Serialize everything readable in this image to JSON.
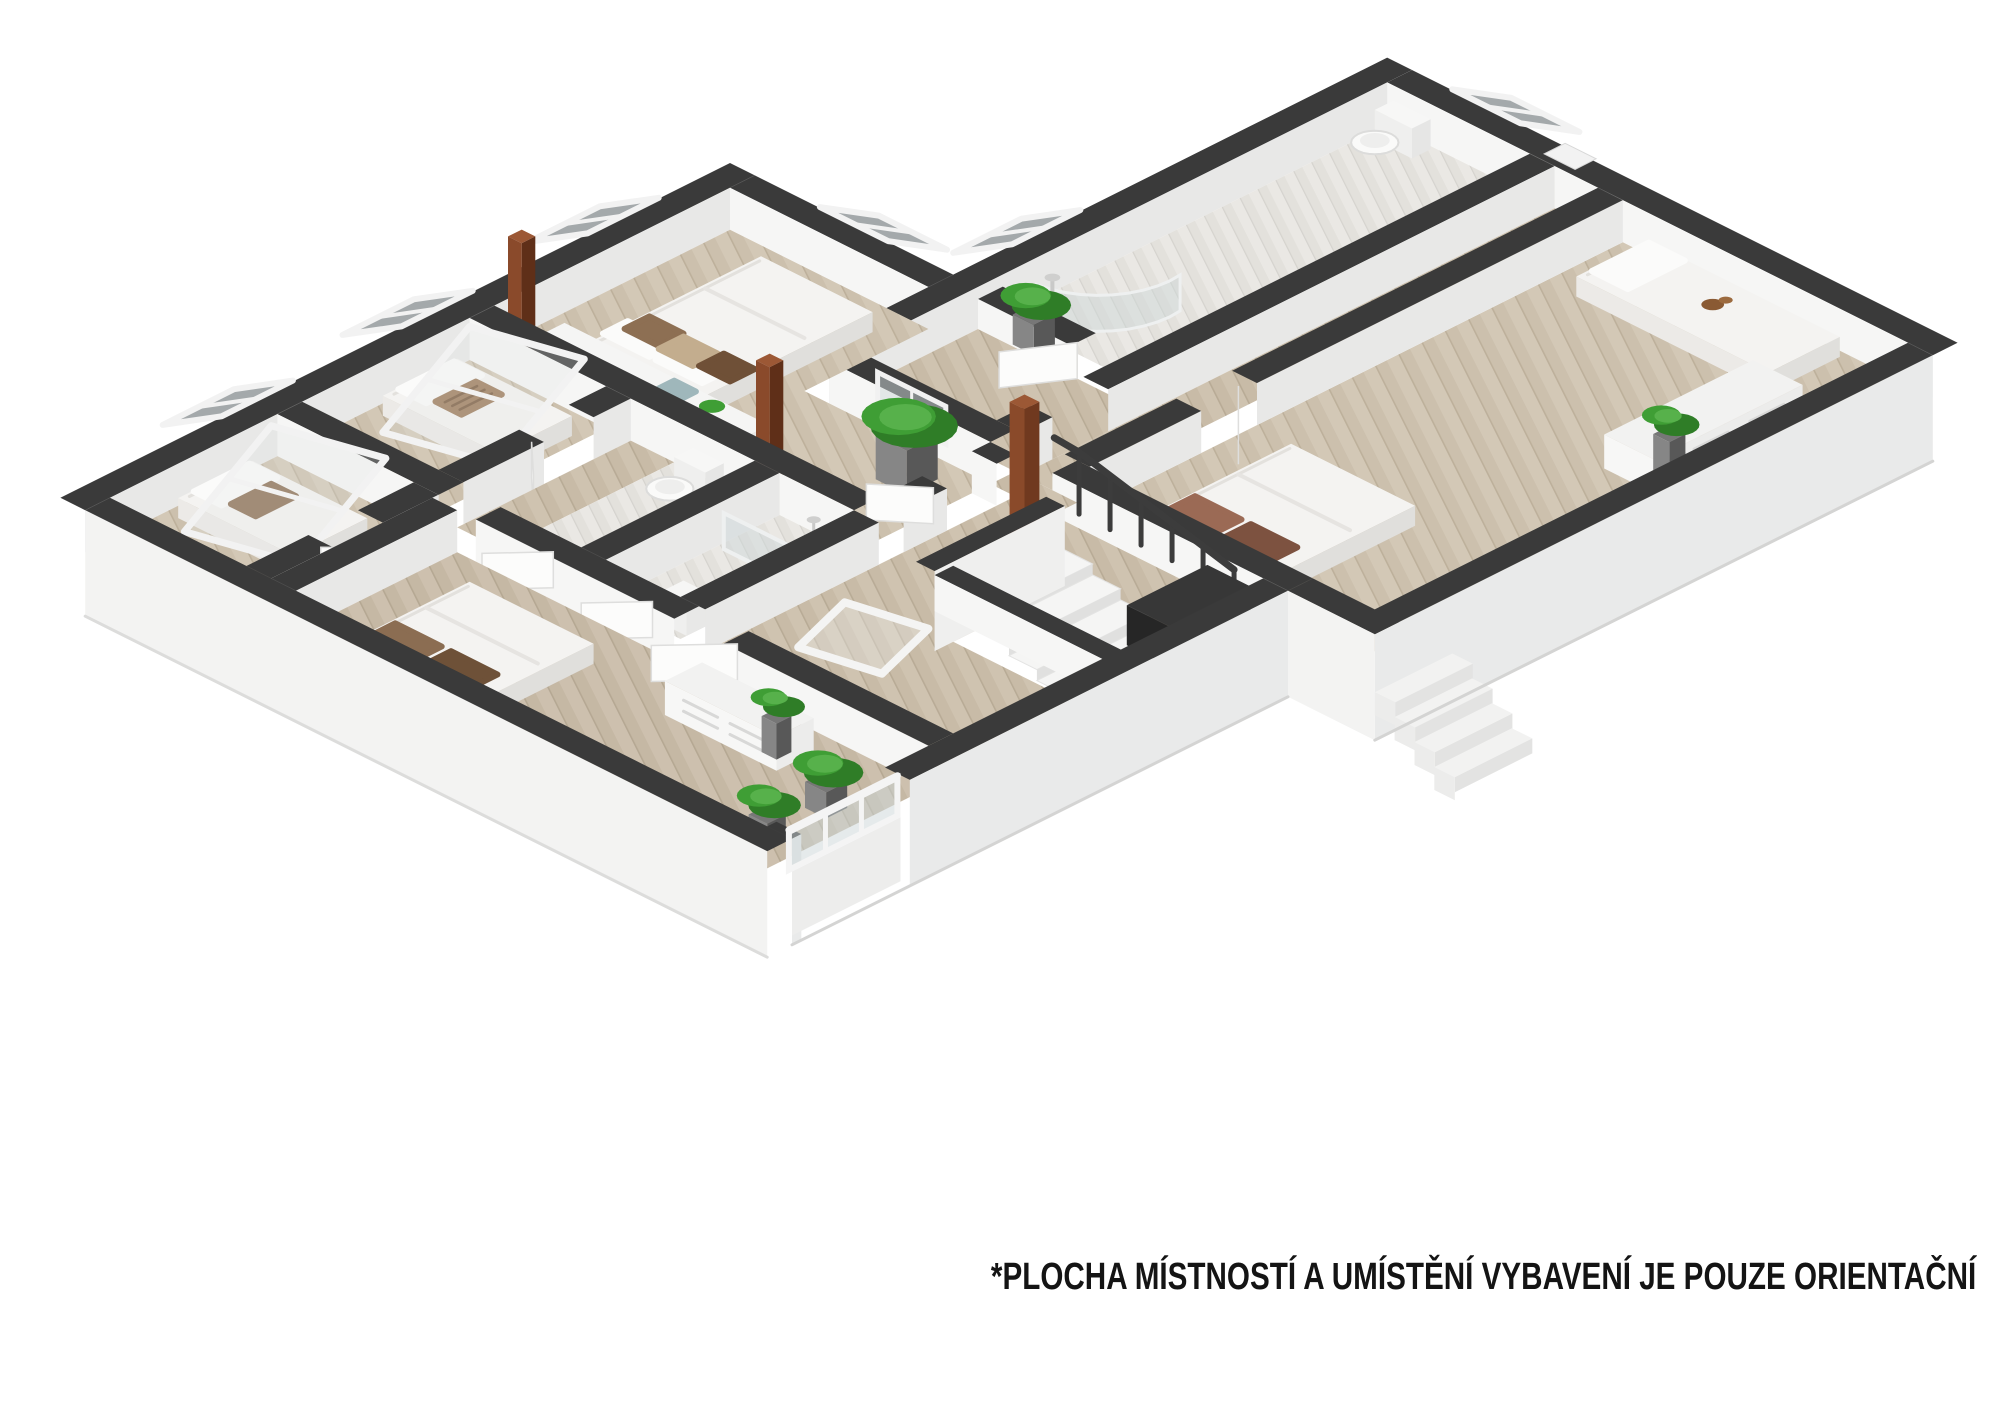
{
  "image_type": "3d-isometric-floor-plan-render",
  "disclaimer": "*PLOCHA MÍSTNOSTÍ  A UMÍSTĚNÍ VYBAVENÍ JE POUZE ORIENTAČNÍ",
  "palette": {
    "background": "#ffffff",
    "wall_top": "#3a3a3a",
    "wall_face_light": "#f6f6f5",
    "wall_face_shade": "#e8e8e7",
    "exterior_face": "#f3f3f2",
    "floor_wood": "#cfc3b0",
    "floor_tile": "#e9e7e3",
    "wood_post": "#7c4024",
    "plant_green": "#3f9e35",
    "glass": "#ccd6d8",
    "stairs": "#f5f5f4",
    "railing": "#3c3c3c",
    "text": "#141414"
  },
  "rooms": [
    {
      "id": "bedroom-northwest",
      "name": "bedroom northwest",
      "furniture": [
        "double-bed",
        "pillows",
        "headboard-shelf",
        "potted-plant-large",
        "wood-post",
        "wood-post",
        "door"
      ]
    },
    {
      "id": "bedroom-west",
      "name": "bedroom west",
      "furniture": [
        "single-bed",
        "striped-pillow",
        "leaning-roof-window-frame",
        "door"
      ]
    },
    {
      "id": "bedroom-southwest",
      "name": "bedroom southwest",
      "furniture": [
        "single-bed",
        "leaning-roof-window-frame",
        "door"
      ]
    },
    {
      "id": "wc-left",
      "name": "wc",
      "furniture": [
        "toilet",
        "door"
      ]
    },
    {
      "id": "bathroom-left",
      "name": "bathroom",
      "furniture": [
        "shower-glass",
        "washbasin",
        "door"
      ]
    },
    {
      "id": "bedroom-south",
      "name": "bedroom south",
      "furniture": [
        "double-bed",
        "brown-pillows",
        "dresser",
        "dresser-plant",
        "glass-partition",
        "potted-plant",
        "potted-plant",
        "door"
      ]
    },
    {
      "id": "hall",
      "name": "hall with staircase",
      "furniture": [
        "wood-column",
        "floor-skylight-frame",
        "staircase",
        "railing",
        "masonry-block"
      ]
    },
    {
      "id": "bathroom-right",
      "name": "bathroom right wing",
      "furniture": [
        "corner-shower",
        "toilet",
        "half-wall-plant",
        "door"
      ]
    },
    {
      "id": "hallway-right",
      "name": "hallway right wing",
      "furniture": [
        "door"
      ]
    },
    {
      "id": "bedroom-east",
      "name": "bedroom east",
      "furniture": [
        "single-bed",
        "teddy-bear",
        "dresser",
        "dresser-plant",
        "double-bed",
        "window-recess"
      ]
    }
  ],
  "exterior_features": [
    "roof-windows",
    "gable-vent",
    "exterior-steps",
    "white-plinth-base"
  ],
  "counts": {
    "roof_windows": 6,
    "beds": 6,
    "plants": 7,
    "doors": 8
  }
}
